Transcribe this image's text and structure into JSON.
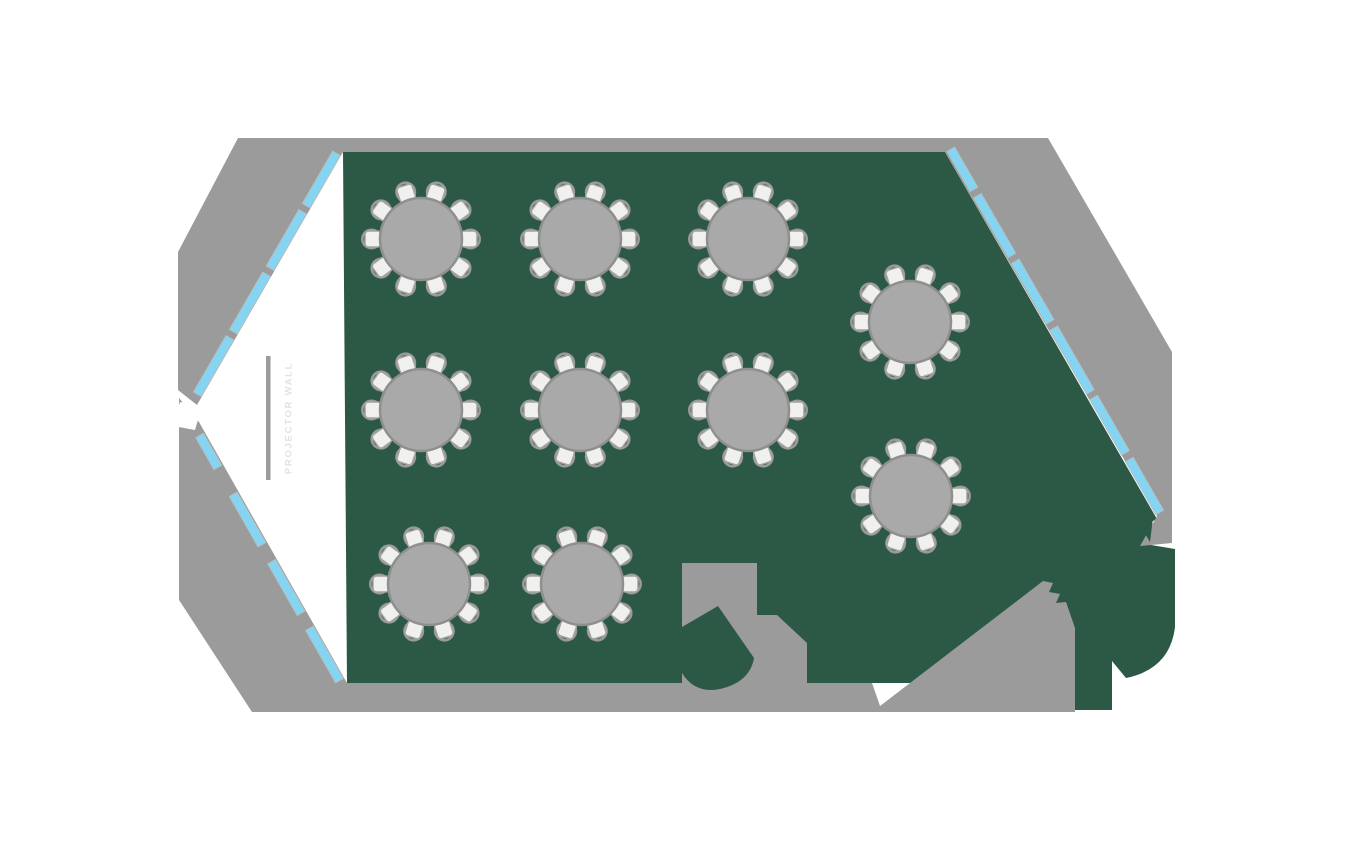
{
  "colors": {
    "background": "#ffffff",
    "wall": "#9b9b9b",
    "floor": "#2c5846",
    "window": "#85d4f2",
    "window_edge": "#b9bdbd",
    "table_fill": "#a9a9a9",
    "table_edge": "#8f8f8f",
    "seat_fill": "#f0f0ee",
    "seat_edge": "#a3a3a1",
    "chair_arc": "#9a9a98",
    "bar": "#9b9b9b",
    "label": "#dfe4e1"
  },
  "labels": {
    "projector_wall": "PROJECTOR WALL"
  },
  "shapes": [
    {
      "name": "floor",
      "fill": "floor",
      "interactable": "false",
      "path": "M343,152 L945,152 L1157,519 L1147,524 L1151,545 L1175,549 L1175,627 Q1170,669 1126,678 L1112,661 L1112,710 L1073,710 L1073,683 L347,683 Z"
    },
    {
      "name": "wall-upper",
      "fill": "wall",
      "interactable": "false",
      "path": "M238,138 L1048,138 L1172,352 L1172,543 L1140,546 L1157,516 L945,152 L343,152 L197,405 L178,390 L178,252 Z"
    },
    {
      "name": "wall-lower",
      "fill": "wall",
      "interactable": "false",
      "path": "M179,398 L179,600 L252,712 L1075,712 L1075,628 L1066,602 L1056,603 L1060,594 L1049,592 L1053,583 L1043,581 L880,706 L872,683 L347,683 L199,422 Z"
    },
    {
      "name": "vestibule-block",
      "fill": "wall",
      "interactable": "false",
      "path": "M682,563 L757,563 L757,615 L777,615 L807,643 L807,690 L682,690 Z"
    },
    {
      "name": "floor-wedge",
      "fill": "floor",
      "interactable": "false",
      "path": "M718,606 L682,627 L682,673 Q695,694 720,689 Q750,682 754,658 Z"
    },
    {
      "name": "floor-notch",
      "fill": "floor",
      "interactable": "false",
      "path": "M1139,524 L1153,518 L1150,542 Z"
    },
    {
      "name": "doorway-gap",
      "fill": "background",
      "interactable": "false",
      "path": "M180,402 L202,406 L195,430 L173,426 Z"
    }
  ],
  "windows": {
    "strip_width": 9,
    "inset": 1,
    "walls": [
      {
        "name": "upper-left-wall",
        "x1": 343,
        "y1": 153,
        "x2": 198,
        "y2": 404,
        "nx": -0.866,
        "ny": -0.5,
        "segments": [
          [
            0.012,
            0.221
          ],
          [
            0.245,
            0.47
          ],
          [
            0.494,
            0.723
          ],
          [
            0.747,
            0.972
          ]
        ]
      },
      {
        "name": "lower-left-wall",
        "x1": 200,
        "y1": 425,
        "x2": 346,
        "y2": 681,
        "nx": -0.868,
        "ny": 0.498,
        "segments": [
          [
            0.03,
            0.155
          ],
          [
            0.26,
            0.457
          ],
          [
            0.523,
            0.725
          ],
          [
            0.783,
            0.988
          ]
        ]
      },
      {
        "name": "right-wall",
        "x1": 946,
        "y1": 152,
        "x2": 1156,
        "y2": 517,
        "nx": 0.866,
        "ny": -0.5,
        "segments": [
          [
            0.0,
            0.11
          ],
          [
            0.127,
            0.291
          ],
          [
            0.307,
            0.473
          ],
          [
            0.49,
            0.665
          ],
          [
            0.68,
            0.832
          ],
          [
            0.85,
            0.995
          ]
        ]
      }
    ]
  },
  "projector_wall": {
    "bar_x": 266,
    "bar_y": 356,
    "bar_w": 4.5,
    "bar_h": 124,
    "text_x": 289,
    "text_y": 418,
    "font_size": 9.5,
    "letter_spacing": 1.7
  },
  "tables": {
    "radius": 41,
    "seats_per_table": 10,
    "seat_angles_deg": [
      0,
      36,
      72,
      108,
      144,
      180,
      216,
      252,
      288,
      324
    ],
    "seat_center_r": 48,
    "seat_size": 16,
    "seat_corner_radius": 3.5,
    "arc_center_r": 49.5,
    "arc_r": 9.2,
    "positions": [
      {
        "id": "table-1",
        "x": 421,
        "y": 239
      },
      {
        "id": "table-2",
        "x": 580,
        "y": 239
      },
      {
        "id": "table-3",
        "x": 748,
        "y": 239
      },
      {
        "id": "table-4",
        "x": 421,
        "y": 410
      },
      {
        "id": "table-5",
        "x": 580,
        "y": 410
      },
      {
        "id": "table-6",
        "x": 748,
        "y": 410
      },
      {
        "id": "table-7",
        "x": 429,
        "y": 584
      },
      {
        "id": "table-8",
        "x": 582,
        "y": 584
      },
      {
        "id": "table-9",
        "x": 910,
        "y": 322
      },
      {
        "id": "table-10",
        "x": 911,
        "y": 496
      }
    ]
  }
}
